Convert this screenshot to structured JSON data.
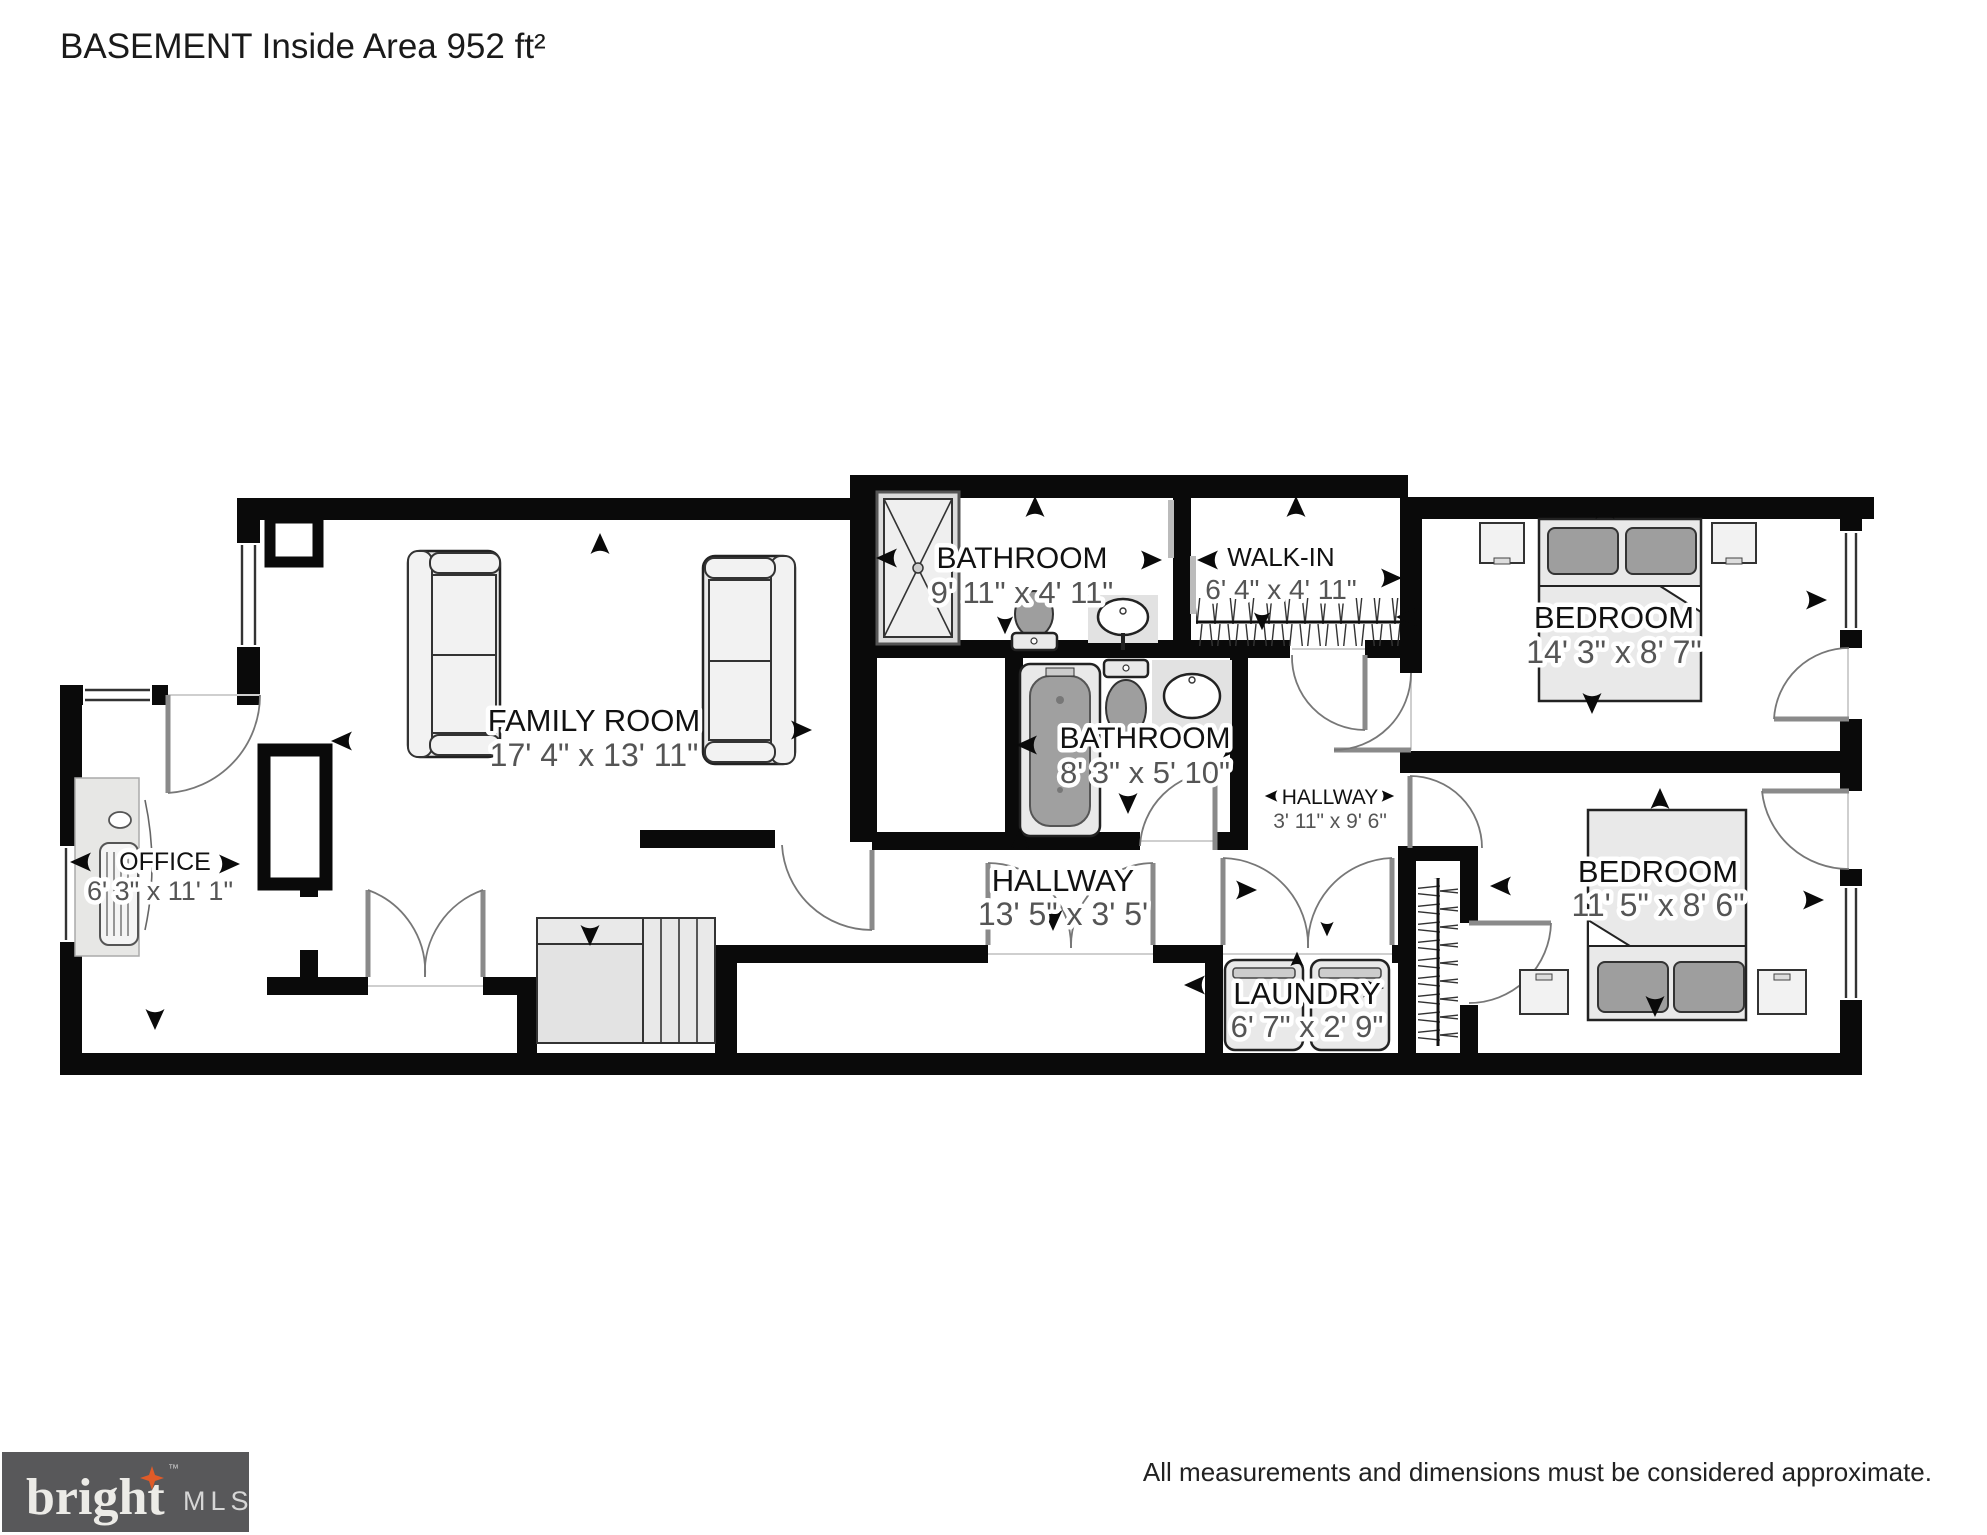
{
  "title": "BASEMENT Inside Area 952 ft²",
  "rooms": [
    {
      "name": "FAMILY ROOM",
      "dims": "17' 4\" x 13' 11\""
    },
    {
      "name": "OFFICE",
      "dims": "6' 3\" x 11' 1\""
    },
    {
      "name": "BATHROOM",
      "dims": "9' 11\" x 4' 11\""
    },
    {
      "name": "WALK-IN",
      "dims": "6' 4\" x 4' 11\""
    },
    {
      "name": "BATHROOM",
      "dims": "8' 3\" x 5' 10\""
    },
    {
      "name": "HALLWAY",
      "dims": "3' 11\" x 9' 6\""
    },
    {
      "name": "BEDROOM",
      "dims": "14' 3\" x 8' 7\""
    },
    {
      "name": "BEDROOM",
      "dims": "11' 5\" x 8' 6\""
    },
    {
      "name": "HALLWAY",
      "dims": "13' 5\" x 3' 5'"
    },
    {
      "name": "LAUNDRY",
      "dims": "6' 7\" x 2' 9\""
    }
  ],
  "footer": {
    "disclaimer": "All measurements and dimensions must be considered approximate.",
    "logo": {
      "brand": "bright",
      "tm": "™",
      "suffix": "MLS"
    }
  },
  "colors": {
    "wall": "#0a0a0a",
    "fixture": "#e9e9e9",
    "logo_bg": "#58585a",
    "accent_star": "#e05b28",
    "label_text": "#111111",
    "dim_text": "#555555"
  }
}
